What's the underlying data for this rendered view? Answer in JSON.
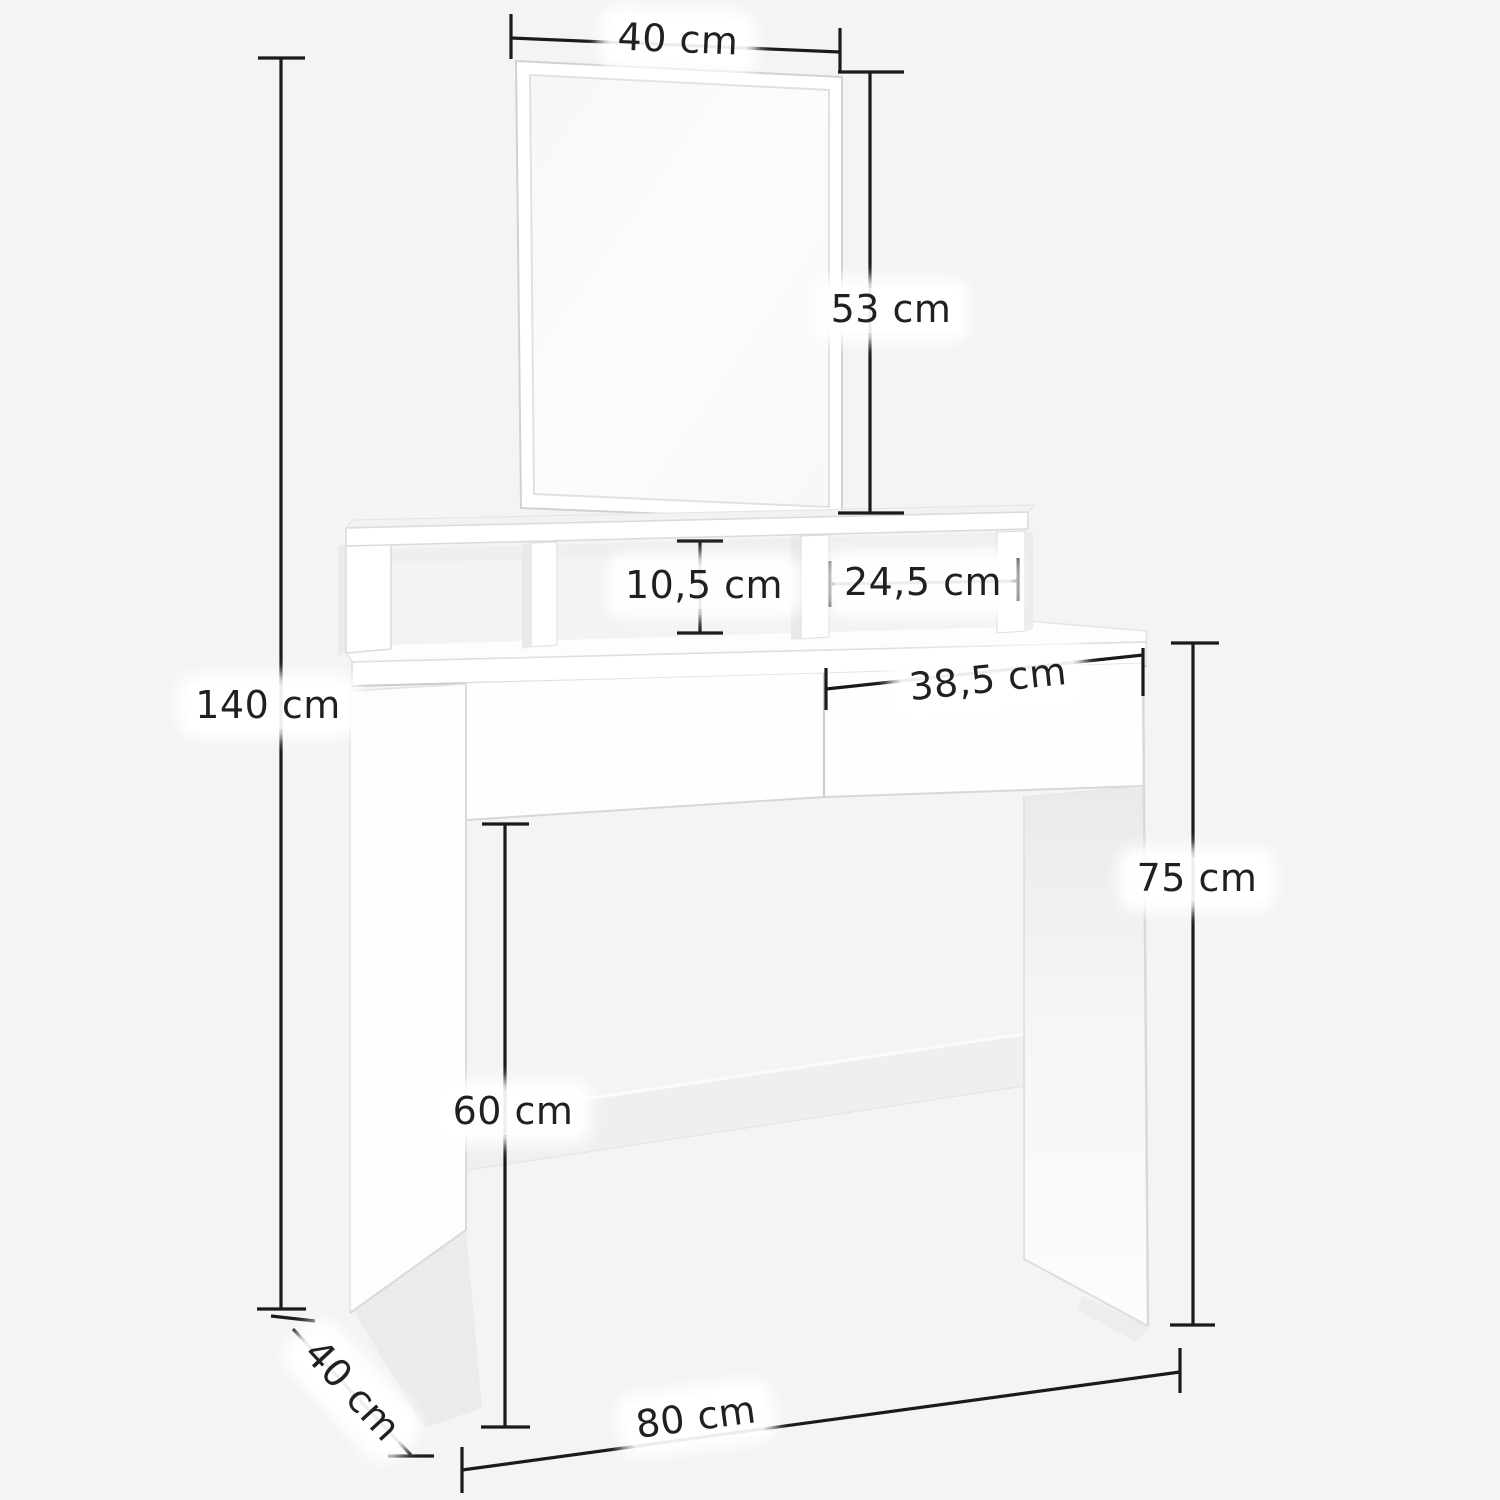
{
  "page": {
    "type": "product-dimension-diagram",
    "product": "dressing table with mirror and open compartments",
    "background": "#f4f4f5"
  },
  "style": {
    "dimension_line_color": "#1a1a1b",
    "label_text_color": "#1f2021",
    "label_halo_color": "#ffffff",
    "furniture_fill": "#ffffff",
    "furniture_shade": "#ececed",
    "furniture_stroke": "#d9dadb"
  },
  "dimensions": {
    "mirror_width": {
      "label": "40 cm"
    },
    "mirror_height": {
      "label": "53 cm"
    },
    "total_height": {
      "label": "140 cm"
    },
    "niche_height": {
      "label": "10,5 cm"
    },
    "niche_width": {
      "label": "24,5 cm"
    },
    "drawer_width": {
      "label": "38,5 cm"
    },
    "table_height": {
      "label": "75 cm"
    },
    "leg_room_height": {
      "label": "60 cm"
    },
    "depth": {
      "label": "40 cm"
    },
    "width": {
      "label": "80 cm"
    }
  }
}
